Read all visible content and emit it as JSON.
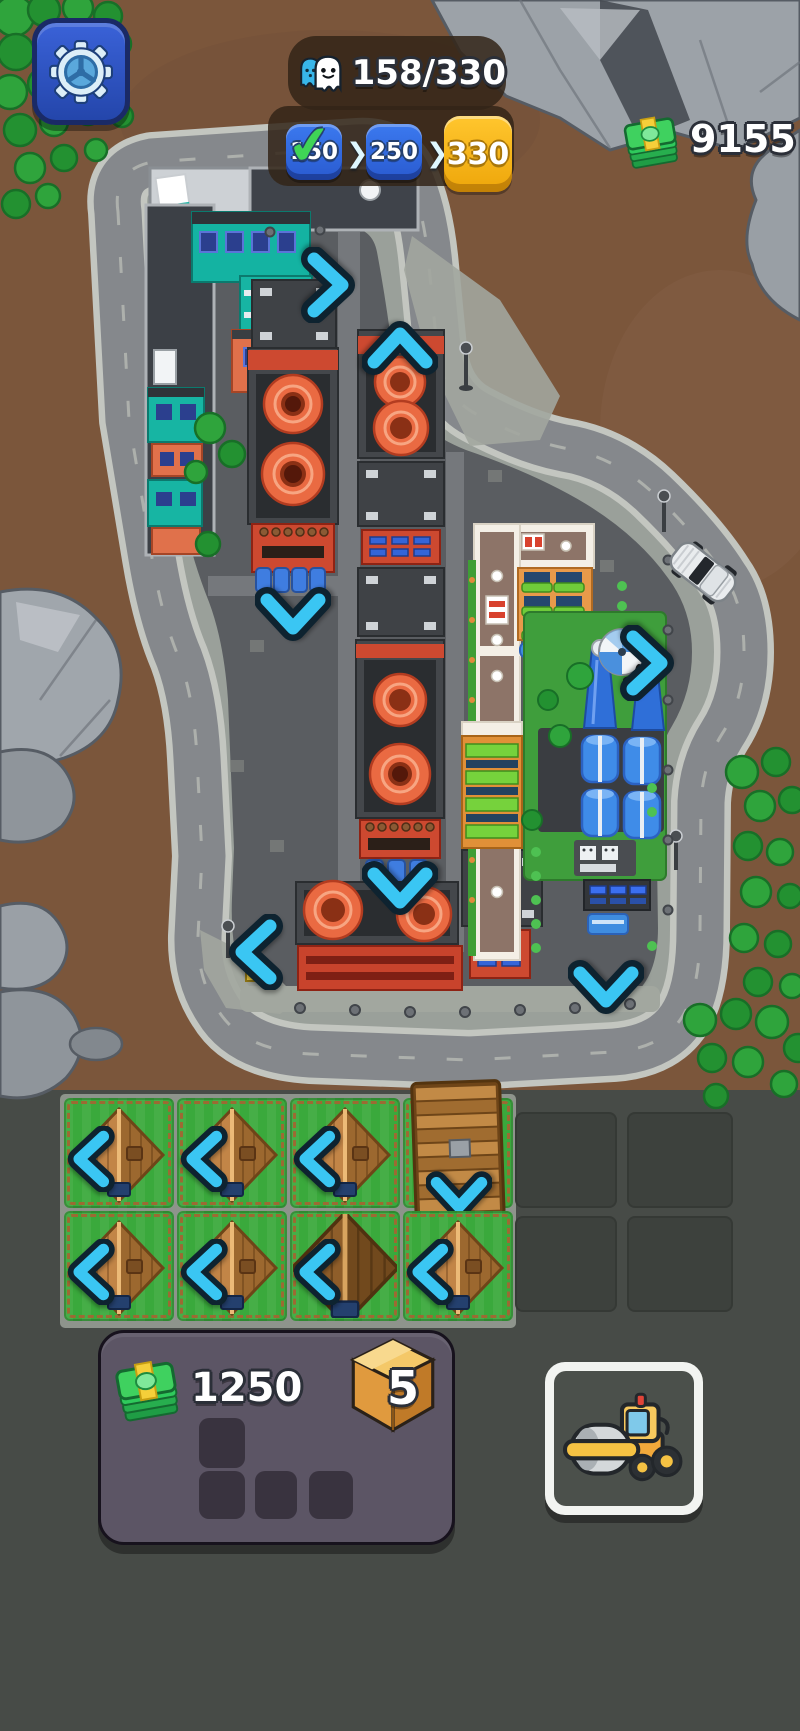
{
  "header": {
    "settings": {
      "icon": "gear-icon"
    },
    "population": {
      "icon": "population-icon",
      "display": "158/330",
      "current": 158,
      "max": 330
    },
    "milestones": {
      "separator": "❯",
      "items": [
        {
          "value": "150",
          "state": "completed",
          "color": "#2f6ce3"
        },
        {
          "value": "250",
          "state": "upcoming",
          "color": "#2f6ce3"
        },
        {
          "value": "330",
          "state": "current-goal",
          "color": "#f5b519"
        }
      ]
    },
    "money": {
      "icon": "cash-icon",
      "value": "9155"
    }
  },
  "map": {
    "arrows": [
      {
        "direction": "right",
        "x": 326,
        "y": 285
      },
      {
        "direction": "up",
        "x": 400,
        "y": 350
      },
      {
        "direction": "down",
        "x": 293,
        "y": 612
      },
      {
        "direction": "right",
        "x": 645,
        "y": 663
      },
      {
        "direction": "down",
        "x": 400,
        "y": 886
      },
      {
        "direction": "left",
        "x": 258,
        "y": 952
      },
      {
        "direction": "down",
        "x": 606,
        "y": 985
      }
    ],
    "vehicle": "white-car"
  },
  "housing": {
    "cells": [
      {
        "row": 0,
        "col": 0,
        "type": "small-house",
        "arrow": "left"
      },
      {
        "row": 0,
        "col": 1,
        "type": "small-house",
        "arrow": "left"
      },
      {
        "row": 0,
        "col": 2,
        "type": "small-house",
        "arrow": "left"
      },
      {
        "row": 0,
        "col": 3,
        "type": "long-house",
        "arrow": "down"
      },
      {
        "row": 1,
        "col": 0,
        "type": "small-house",
        "arrow": "left"
      },
      {
        "row": 1,
        "col": 1,
        "type": "small-house",
        "arrow": "left"
      },
      {
        "row": 1,
        "col": 2,
        "type": "big-house",
        "arrow": "left"
      },
      {
        "row": 1,
        "col": 3,
        "type": "small-house",
        "arrow": "left"
      }
    ],
    "empty_slots": 4
  },
  "resources_panel": {
    "money": {
      "icon": "cash-icon",
      "value": "1250"
    },
    "boxes": {
      "icon": "box-icon",
      "value": "5"
    },
    "slots": 4
  },
  "build_button": {
    "icon": "steamroller-icon"
  },
  "colors": {
    "arrow_cyan": "#3ac6f3",
    "badge_blue": "#2f6ce3",
    "badge_gold": "#f5b519",
    "money_green": "#3fd15f",
    "panel_purple": "#5c5565",
    "ground_dirt": "#7b563b",
    "build_zone": "#474b47"
  }
}
